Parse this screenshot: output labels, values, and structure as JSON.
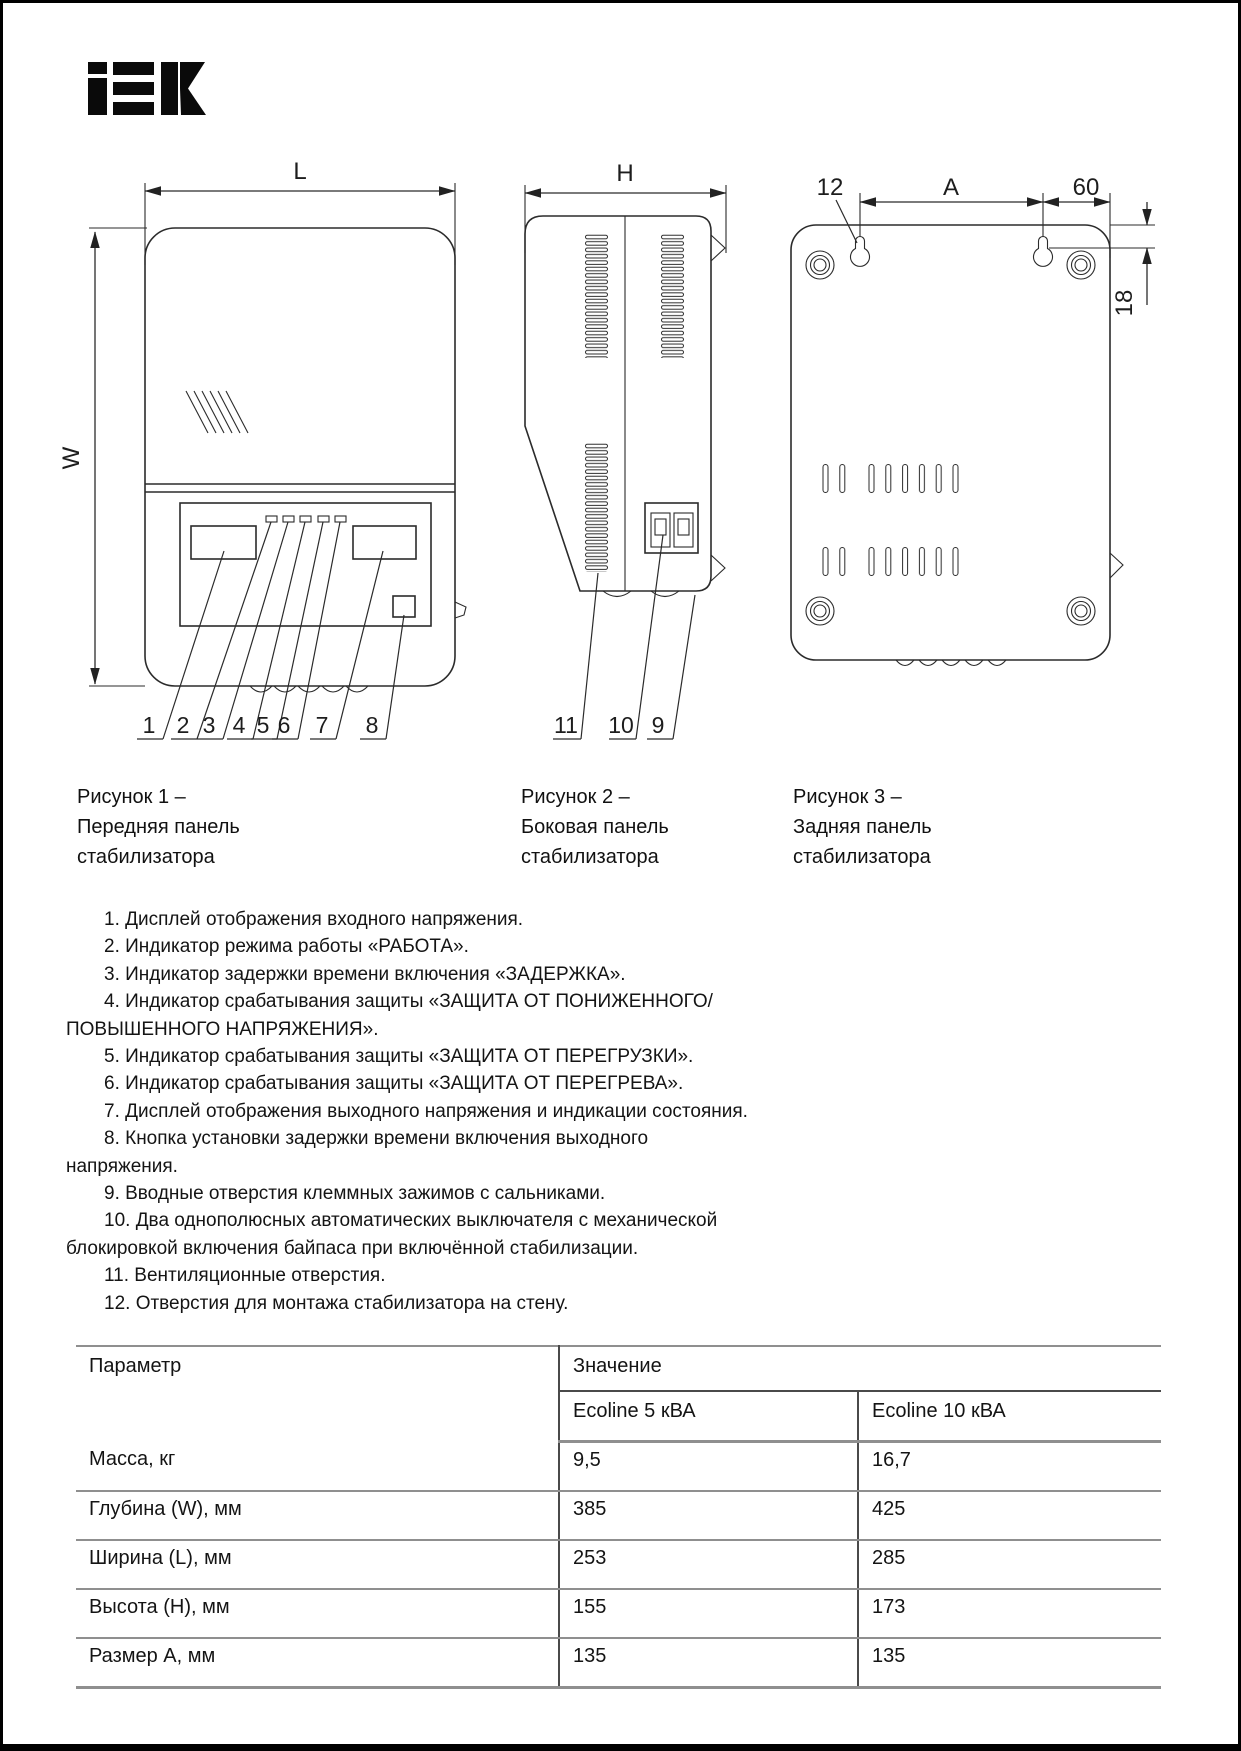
{
  "brand": {
    "name": "IEK"
  },
  "fig1": {
    "dim_l": "L",
    "dim_w": "W",
    "callouts": [
      "1",
      "2",
      "3",
      "4",
      "5",
      "6",
      "7",
      "8"
    ],
    "caption": [
      "Рисунок 1 –",
      "Передняя панель",
      "стабилизатора"
    ]
  },
  "fig2": {
    "dim_h": "H",
    "callouts": [
      "11",
      "10",
      "9"
    ],
    "caption": [
      "Рисунок 2 –",
      "Боковая панель",
      "стабилизатора"
    ]
  },
  "fig3": {
    "dim_hole": "12",
    "dim_a": "A",
    "dim_60": "60",
    "dim_18": "18",
    "caption": [
      "Рисунок 3 –",
      "Задняя панель",
      "стабилизатора"
    ]
  },
  "legend": {
    "lines": [
      "1. Дисплей отображения входного напряжения.",
      "2. Индикатор режима работы «РАБОТА».",
      "3. Индикатор задержки времени включения «ЗАДЕРЖКА».",
      "4. Индикатор срабатывания защиты «ЗАЩИТА ОТ ПОНИЖЕННОГО/",
      "ПОВЫШЕННОГО НАПРЯЖЕНИЯ».",
      "5. Индикатор срабатывания защиты «ЗАЩИТА ОТ ПЕРЕГРУЗКИ».",
      "6. Индикатор срабатывания защиты «ЗАЩИТА ОТ ПЕРЕГРЕВА».",
      "7. Дисплей отображения выходного напряжения и индикации состояния.",
      "8. Кнопка установки задержки времени включения выходного",
      "напряжения.",
      "9. Вводные отверстия клеммных зажимов с сальниками.",
      "10. Два однополюсных автоматических выключателя с механической",
      "блокировкой включения байпаса при включённой стабилизации.",
      "11. Вентиляционные отверстия.",
      "12. Отверстия для монтажа стабилизатора на стену."
    ]
  },
  "table": {
    "param_header": "Параметр",
    "value_header": "Значение",
    "columns": [
      "Ecoline 5 кВА",
      "Ecoline 10 кВА"
    ],
    "rows": [
      {
        "param": "Масса, кг",
        "v1": "9,5",
        "v2": "16,7"
      },
      {
        "param": "Глубина (W), мм",
        "v1": "385",
        "v2": "425"
      },
      {
        "param": "Ширина (L), мм",
        "v1": "253",
        "v2": "285"
      },
      {
        "param": "Высота (H), мм",
        "v1": "155",
        "v2": "173"
      },
      {
        "param": "Размер А, мм",
        "v1": "135",
        "v2": "135"
      }
    ]
  }
}
